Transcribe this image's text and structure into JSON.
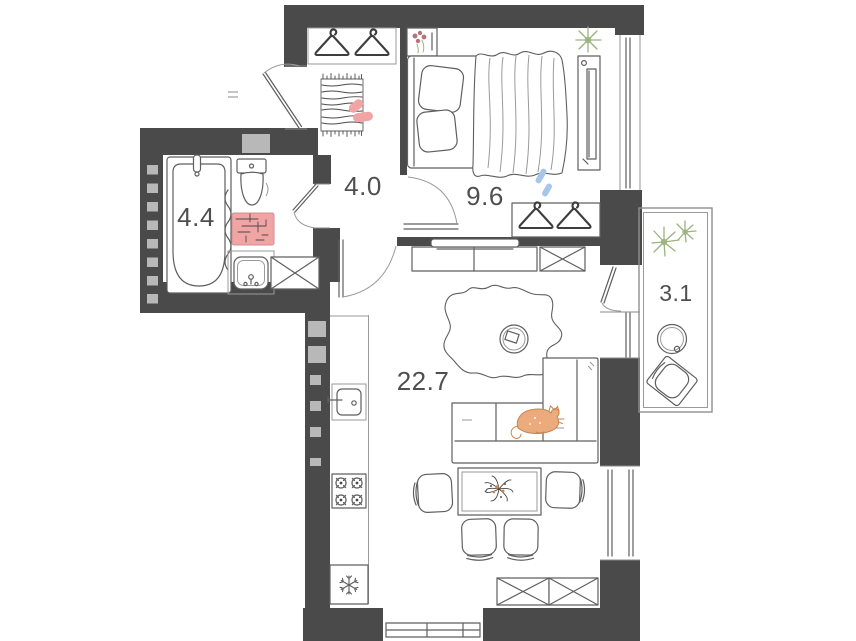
{
  "floor_plan": {
    "rooms": [
      {
        "name": "bathroom",
        "area_label": "4.4"
      },
      {
        "name": "hallway",
        "area_label": "4.0"
      },
      {
        "name": "bedroom",
        "area_label": "9.6"
      },
      {
        "name": "living-kitchen",
        "area_label": "22.7"
      },
      {
        "name": "balcony",
        "area_label": "3.1"
      }
    ],
    "colors": {
      "wall": "#4a4a4a",
      "wall_inset": "#b8b8b8",
      "line": "#5f5f5f",
      "label_text": "#4f4f4f",
      "accent_pink": "#f0a4a4",
      "accent_orange": "#ecab7d",
      "accent_blue": "#a7c7ea",
      "accent_green": "#9cb37e",
      "accent_flower": "#b5737e"
    },
    "furniture": {
      "bathroom": [
        "bathtub",
        "toilet",
        "bath-mat",
        "sink",
        "washing-machine",
        "towel"
      ],
      "hallway": [
        "coat-hangers",
        "striped-rug",
        "slippers",
        "entrance-door"
      ],
      "bedroom": [
        "double-bed",
        "pillows",
        "blanket",
        "nightstand-flowers",
        "plant",
        "wardrobe-panel",
        "hanger-closet",
        "window"
      ],
      "living_kitchen": [
        "tv-stand",
        "storage-box",
        "rug",
        "coffee-table",
        "corner-sofa",
        "cat",
        "dining-table",
        "chairs",
        "stove",
        "fridge",
        "kitchen-sink",
        "storage-boxes",
        "window"
      ],
      "balcony": [
        "plant",
        "round-table",
        "chair"
      ]
    }
  }
}
